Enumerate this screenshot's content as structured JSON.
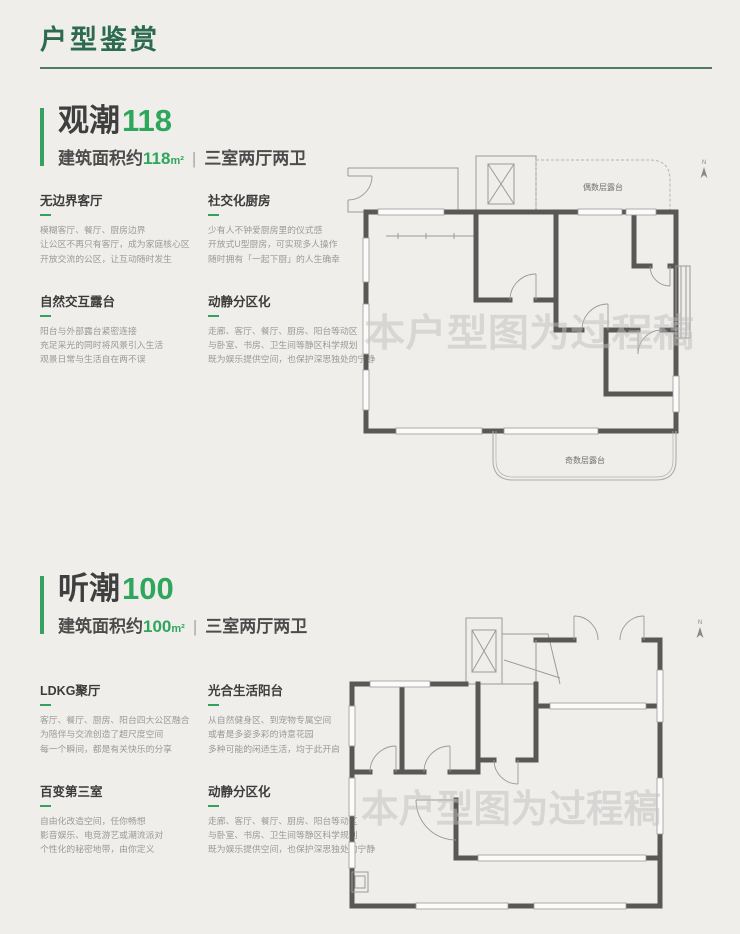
{
  "page": {
    "title": "户型鉴赏",
    "watermark": "本户型图为过程稿",
    "separator": "|"
  },
  "colors": {
    "header_green": "#2c6b50",
    "accent_green": "#35a15f",
    "number_green": "#2ea65c",
    "text_dark": "#3f3f3f",
    "text_gray": "#9a9a98",
    "background": "#efeeeb"
  },
  "sections": [
    {
      "title_text": "观潮",
      "title_number": "118",
      "area_prefix": "建筑面积约",
      "area_value": "118",
      "area_unit": "m²",
      "layout_desc": "三室两厅两卫",
      "features": [
        {
          "title": "无边界客厅",
          "lines": [
            "模糊客厅、餐厅、厨房边界",
            "让公区不再只有客厅，成为家庭核心区",
            "开放交流的公区，让互动随时发生"
          ]
        },
        {
          "title": "社交化厨房",
          "lines": [
            "少有人不钟爱厨房里的仪式感",
            "开放式U型厨房，可实现多人操作",
            "随时拥有「一起下厨」的人生确幸"
          ]
        },
        {
          "title": "自然交互露台",
          "lines": [
            "阳台与外部露台紧密连接",
            "充足采光的同时将风景引入生活",
            "观景日常与生活自在两不误"
          ]
        },
        {
          "title": "动静分区化",
          "lines": [
            "走廊、客厅、餐厅、厨房、阳台等动区",
            "与卧室、书房、卫生间等静区科学规划",
            "既为娱乐提供空间，也保护深思独处的宁静"
          ]
        }
      ],
      "plan": {
        "terrace_top_label": "偶数层露台",
        "terrace_bottom_label": "奇数层露台",
        "north_label": "N"
      }
    },
    {
      "title_text": "听潮",
      "title_number": "100",
      "area_prefix": "建筑面积约",
      "area_value": "100",
      "area_unit": "m²",
      "layout_desc": "三室两厅两卫",
      "features": [
        {
          "title": "LDKG聚厅",
          "lines": [
            "客厅、餐厅、厨房、阳台四大公区融合",
            "为陪伴与交流创造了超尺度空间",
            "每一个瞬间，都是有关快乐的分享"
          ]
        },
        {
          "title": "光合生活阳台",
          "lines": [
            "从自然健身区、到宠物专属空间",
            "或者是多姿多彩的诗意花园",
            "多种可能的闲适生活，均于此开启"
          ]
        },
        {
          "title": "百变第三室",
          "lines": [
            "自由化改造空间，任你畅想",
            "影音娱乐、电竞游艺或潮流派对",
            "个性化的秘密地带，由你定义"
          ]
        },
        {
          "title": "动静分区化",
          "lines": [
            "走廊、客厅、餐厅、厨房、阳台等动区",
            "与卧室、书房、卫生间等静区科学规划",
            "既为娱乐提供空间，也保护深思独处的宁静"
          ]
        }
      ],
      "plan": {
        "north_label": "N"
      }
    }
  ]
}
